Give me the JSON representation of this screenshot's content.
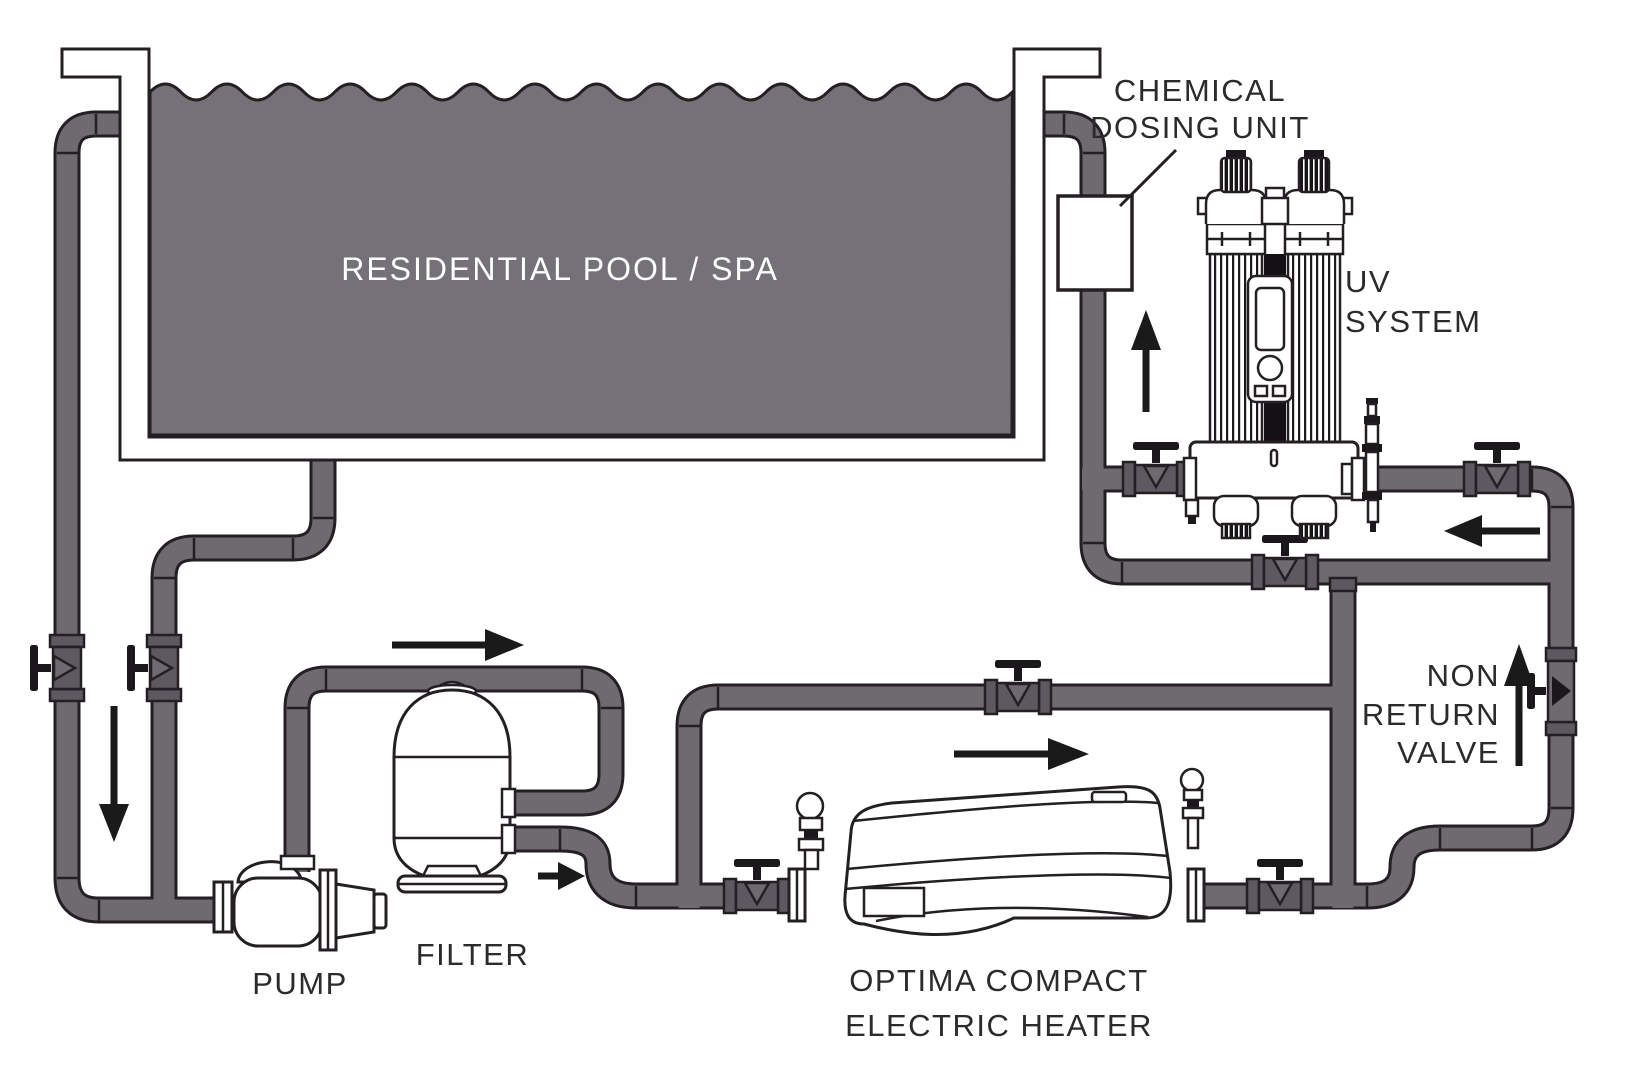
{
  "title": "Residential pool / spa water treatment installation diagram",
  "colors": {
    "water": "#757178",
    "pipe": "#6e6a70",
    "fitting": "#5d5960",
    "outline": "#231f23",
    "metal": "#1b181b",
    "arrow": "#1a1a1a",
    "text": "#2d2a2d",
    "pool_text": "#ffffff",
    "bg": "#ffffff"
  },
  "labels": {
    "pool": "RESIDENTIAL POOL / SPA",
    "dosing_line1": "CHEMICAL",
    "dosing_line2": "DOSING UNIT",
    "uv_line1": "UV",
    "uv_line2": "SYSTEM",
    "nrv_line1": "NON",
    "nrv_line2": "RETURN",
    "nrv_line3": "VALVE",
    "pump": "PUMP",
    "filter": "FILTER",
    "heater_line1": "OPTIMA COMPACT",
    "heater_line2": "ELECTRIC HEATER"
  },
  "components": [
    "residential-pool-spa",
    "chemical-dosing-unit",
    "uv-system",
    "non-return-valve",
    "pump",
    "filter",
    "optima-compact-electric-heater"
  ],
  "flow_arrows": [
    {
      "name": "flow-arrow-down-suction",
      "direction": "down"
    },
    {
      "name": "flow-arrow-right-pump-to-filter",
      "direction": "right"
    },
    {
      "name": "flow-arrow-right-filter-out",
      "direction": "right"
    },
    {
      "name": "flow-arrow-right-heater",
      "direction": "right"
    },
    {
      "name": "flow-arrow-up-non-return",
      "direction": "up"
    },
    {
      "name": "flow-arrow-left-uv-return",
      "direction": "left"
    },
    {
      "name": "flow-arrow-up-dosing-return",
      "direction": "up"
    }
  ]
}
